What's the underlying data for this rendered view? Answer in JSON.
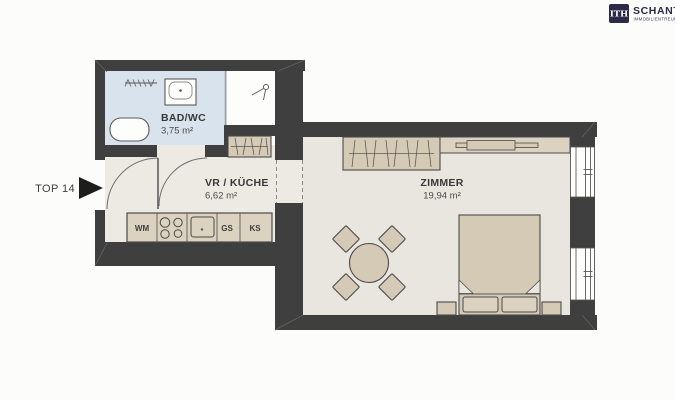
{
  "logo": {
    "box": "ITH",
    "name": "SCHANTL",
    "subtitle": "IMMOBILIENTREUHAND GMBH"
  },
  "entry": {
    "label": "TOP 14"
  },
  "rooms": {
    "bad": {
      "name": "BAD/WC",
      "area": "3,75 m²"
    },
    "vr": {
      "name": "VR / KÜCHE",
      "area": "6,62 m²"
    },
    "zimmer": {
      "name": "ZIMMER",
      "area": "19,94 m²"
    }
  },
  "kitchen": {
    "wm": "WM",
    "gs": "GS",
    "ks": "KS"
  },
  "icons": [
    "entry-arrow-icon",
    "bathtub",
    "washbasin",
    "radiator-icon",
    "vent-icon",
    "stove-burners",
    "kitchen-sink",
    "wardrobe-hatch",
    "window",
    "bed",
    "dining-table"
  ],
  "colors": {
    "wall": "#3f3f3f",
    "bath_floor": "#d9e3ee",
    "hall_floor": "#edeae3",
    "room_floor": "#e9e6df",
    "furniture": "#d5cab6",
    "logo_navy": "#2b2a47",
    "background": "#fcfcfb"
  }
}
